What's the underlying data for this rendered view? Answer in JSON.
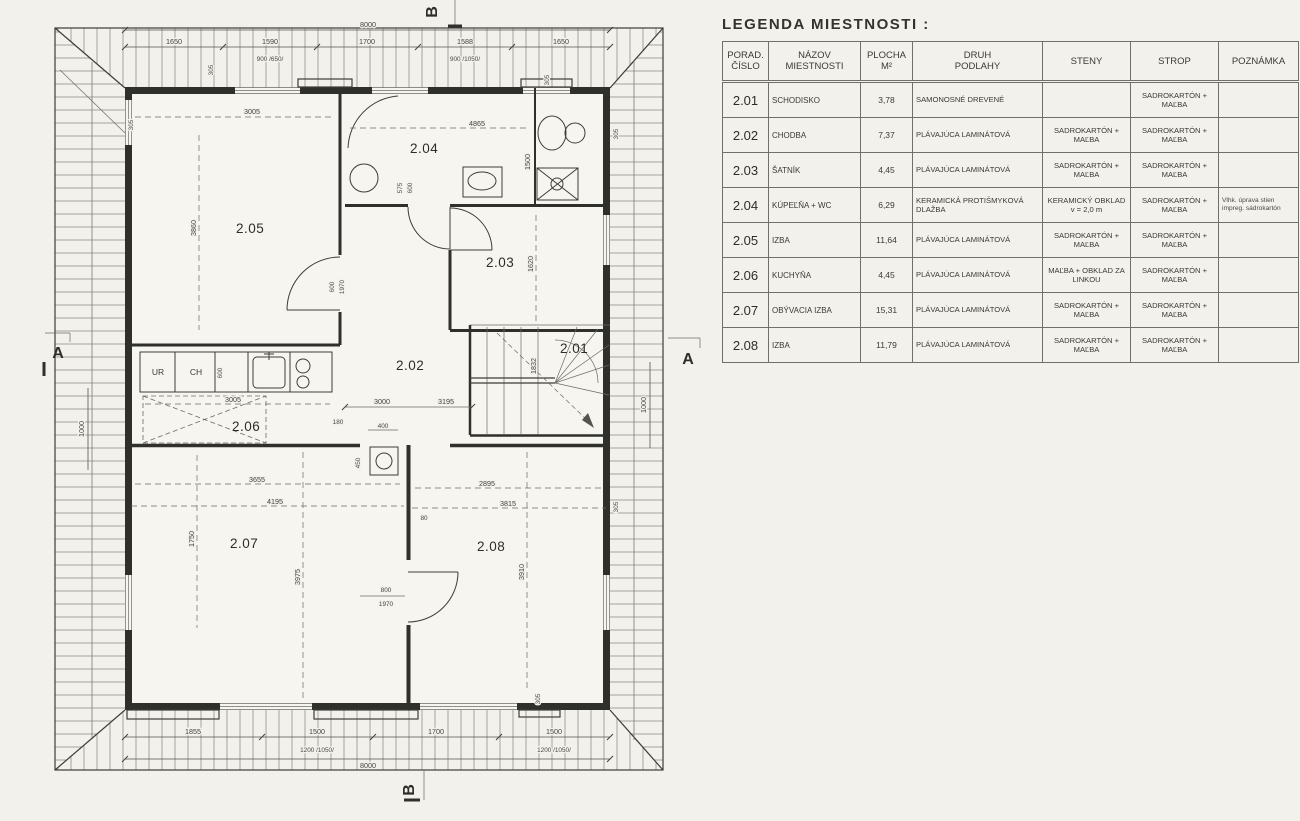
{
  "legend": {
    "title": "LEGENDA MIESTNOSTI :",
    "headers": {
      "num": "PORAD.\nČÍSLO",
      "name": "NÁZOV\nMIESTNOSTI",
      "area": "PLOCHA\nM²",
      "floor": "DRUH\nPODLAHY",
      "walls": "STENY",
      "ceiling": "STROP",
      "note": "POZNÁMKA"
    },
    "rows": [
      {
        "num": "2.01",
        "name": "SCHODISKO",
        "area": "3,78",
        "floor": "SAMONOSNÉ DREVENÉ",
        "walls": "",
        "ceiling": "SADROKARTÓN + MAĽBA",
        "note": ""
      },
      {
        "num": "2.02",
        "name": "CHODBA",
        "area": "7,37",
        "floor": "PLÁVAJÚCA LAMINÁTOVÁ",
        "walls": "SADROKARTÓN + MAĽBA",
        "ceiling": "SADROKARTÓN + MAĽBA",
        "note": ""
      },
      {
        "num": "2.03",
        "name": "ŠATNÍK",
        "area": "4,45",
        "floor": "PLÁVAJÚCA LAMINÁTOVÁ",
        "walls": "SADROKARTÓN + MAĽBA",
        "ceiling": "SADROKARTÓN + MAĽBA",
        "note": ""
      },
      {
        "num": "2.04",
        "name": "KÚPEĽŇA + WC",
        "area": "6,29",
        "floor": "KERAMICKÁ PROTIŠMYKOVÁ DLAŽBA",
        "walls": "KERAMICKÝ OBKLAD v = 2,0 m",
        "ceiling": "SADROKARTÓN + MAĽBA",
        "note": "Vlhk. úprava stien impreg. sádrokartón"
      },
      {
        "num": "2.05",
        "name": "IZBA",
        "area": "11,64",
        "floor": "PLÁVAJÚCA LAMINÁTOVÁ",
        "walls": "SADROKARTÓN + MAĽBA",
        "ceiling": "SADROKARTÓN + MAĽBA",
        "note": ""
      },
      {
        "num": "2.06",
        "name": "KUCHYŇA",
        "area": "4,45",
        "floor": "PLÁVAJÚCA LAMINÁTOVÁ",
        "walls": "MAĽBA + OBKLAD ZA LINKOU",
        "ceiling": "SADROKARTÓN + MAĽBA",
        "note": ""
      },
      {
        "num": "2.07",
        "name": "OBÝVACIA IZBA",
        "area": "15,31",
        "floor": "PLÁVAJÚCA LAMINÁTOVÁ",
        "walls": "SADROKARTÓN + MAĽBA",
        "ceiling": "SADROKARTÓN + MAĽBA",
        "note": ""
      },
      {
        "num": "2.08",
        "name": "IZBA",
        "area": "11,79",
        "floor": "PLÁVAJÚCA LAMINÁTOVÁ",
        "walls": "SADROKARTÓN + MAĽBA",
        "ceiling": "SADROKARTÓN + MAĽBA",
        "note": ""
      }
    ]
  },
  "plan": {
    "rooms": {
      "r201": "2.01",
      "r202": "2.02",
      "r203": "2.03",
      "r204": "2.04",
      "r205": "2.05",
      "r206": "2.06",
      "r207": "2.07",
      "r208": "2.08"
    },
    "appliances": {
      "ur": "UR",
      "ch": "CH"
    },
    "sections": {
      "a": "A",
      "b": "B"
    },
    "dims": {
      "top_overall": "8000",
      "top": [
        "1650",
        "1590",
        "1700",
        "1588",
        "1650"
      ],
      "top_sub": [
        "900 /650/",
        "900 /1050/"
      ],
      "bottom": [
        "1855",
        "1500",
        "1700",
        "1500"
      ],
      "bottom_sub": [
        "1200 /1050/",
        "1200 /1050/"
      ],
      "bottom_overall": "8000",
      "left_side": "1000",
      "right_side": "1000",
      "m305": "305",
      "r205_w": "3005",
      "r205_h": "3860",
      "r204_w": "4865",
      "r204_h": "1500",
      "bath_door_a": "575",
      "bath_door_b": "600",
      "r203_h": "1620",
      "stair_h": "1832",
      "hall_a": "3000",
      "hall_b": "3195",
      "hall_c": "180",
      "hall_d": "400",
      "hall_e": "450",
      "door205_w": "600",
      "door205_h": "1970",
      "kitchen_w": "3005",
      "kitchen_d": "600",
      "r207_a": "3655",
      "r207_b": "4195",
      "r207_c": "1750",
      "r207_d": "3975",
      "r208_a": "2895",
      "r208_b": "3815",
      "r208_c": "3910",
      "wall80": "80",
      "door208_w": "800",
      "door208_h": "1970"
    }
  }
}
